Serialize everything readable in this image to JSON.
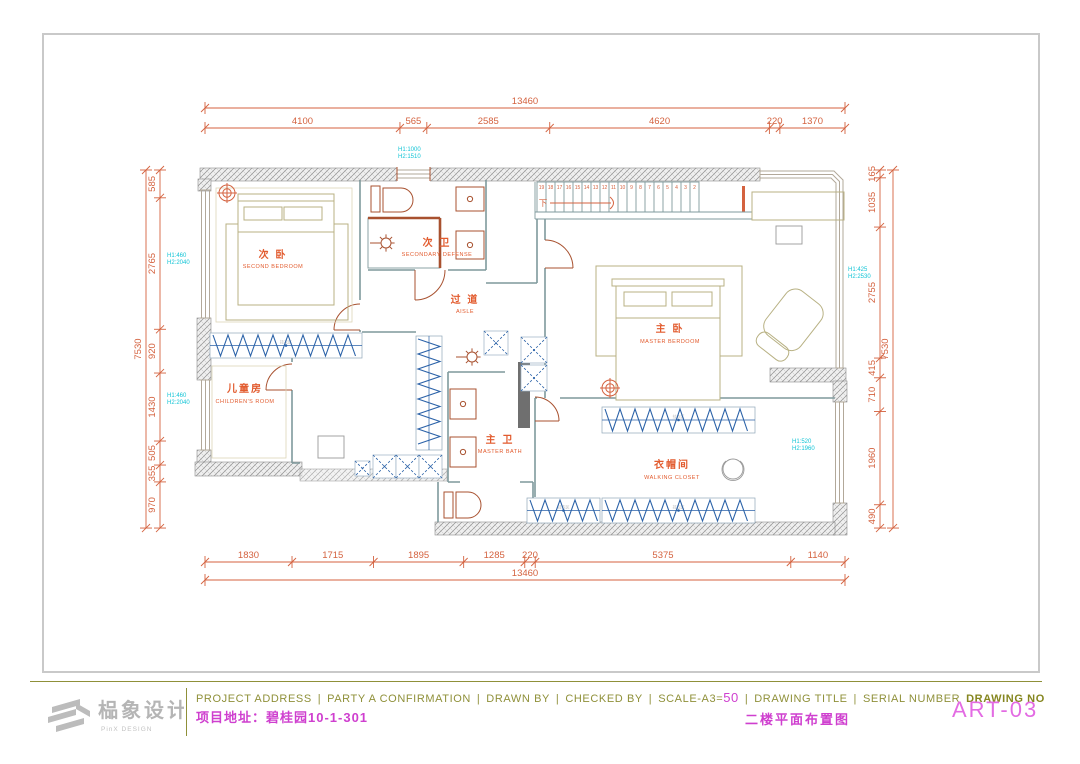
{
  "colors": {
    "dimension": "#d4623f",
    "cyan_note": "#12c4d6",
    "wall_line": "#7f999c",
    "closet_blue": "#2b62a8",
    "olive_text": "#8f9039",
    "magenta": "#cf3fcf",
    "furniture": "#b8b183",
    "fixture": "#a8512f"
  },
  "dims": {
    "top": {
      "overall": "13460",
      "segments": [
        4100,
        565,
        2585,
        4620,
        220,
        1370
      ]
    },
    "bottom": {
      "overall": "13460",
      "segments": [
        1830,
        1715,
        1895,
        1285,
        220,
        5375,
        1140
      ]
    },
    "left": {
      "overall": "7530",
      "segments": [
        585,
        2765,
        920,
        1430,
        505,
        355,
        970
      ]
    },
    "right": {
      "overall": "7530",
      "segments": [
        165,
        1035,
        2755,
        415,
        710,
        1960,
        490
      ]
    }
  },
  "annotations": {
    "top": {
      "h1": "H1:1000",
      "h2": "H2:1510"
    },
    "left_upper": {
      "h1": "H1:460",
      "h2": "H2:2040"
    },
    "left_lower": {
      "h1": "H1:460",
      "h2": "H2:2040"
    },
    "right_upper": {
      "h1": "H1:425",
      "h2": "H2:2530"
    },
    "right_lower": {
      "h1": "H1:520",
      "h2": "H2:1960"
    }
  },
  "stairs": {
    "down_label": "下",
    "numbers": [
      "19",
      "18",
      "17",
      "16",
      "15",
      "14",
      "13",
      "12",
      "11",
      "10",
      "9",
      "8",
      "7",
      "6",
      "5",
      "4",
      "3",
      "2"
    ]
  },
  "rooms": {
    "second_bedroom": {
      "cn": "次 卧",
      "en": "SECOND BEDROOM"
    },
    "secondary_bath": {
      "cn": "次 卫",
      "en": "SECONDARY DEFENSE"
    },
    "aisle": {
      "cn": "过 道",
      "en": "AISLE"
    },
    "master_bedroom": {
      "cn": "主 卧",
      "en": "MASTER BERDOOM"
    },
    "children_room": {
      "cn": "儿童房",
      "en": "CHILDREN'S ROOM"
    },
    "master_bath": {
      "cn": "主 卫",
      "en": "MASTER BATH"
    },
    "walking_closet": {
      "cn": "衣帽间",
      "en": "WALKING CLOSET"
    }
  },
  "wardrobe_zone_label": "挂衣区",
  "title_block": {
    "logo_cn": "榀象设计",
    "logo_sub": "PinX DESIGN",
    "labels": {
      "project_address": "PROJECT ADDRESS",
      "party_a": "PARTY A CONFIRMATION",
      "drawn_by": "DRAWN BY",
      "checked_by": "CHECKED BY",
      "scale": "SCALE-A3=",
      "scale_value": "50",
      "drawing_title": "DRAWING TITLE",
      "serial_number": "SERIAL NUMBER",
      "drawing_no": "DRAWING NO"
    },
    "values": {
      "project_address": "项目地址：碧桂园10-1-301",
      "drawing_title": "二楼平面布置图",
      "drawing_no": "ART-03"
    }
  }
}
